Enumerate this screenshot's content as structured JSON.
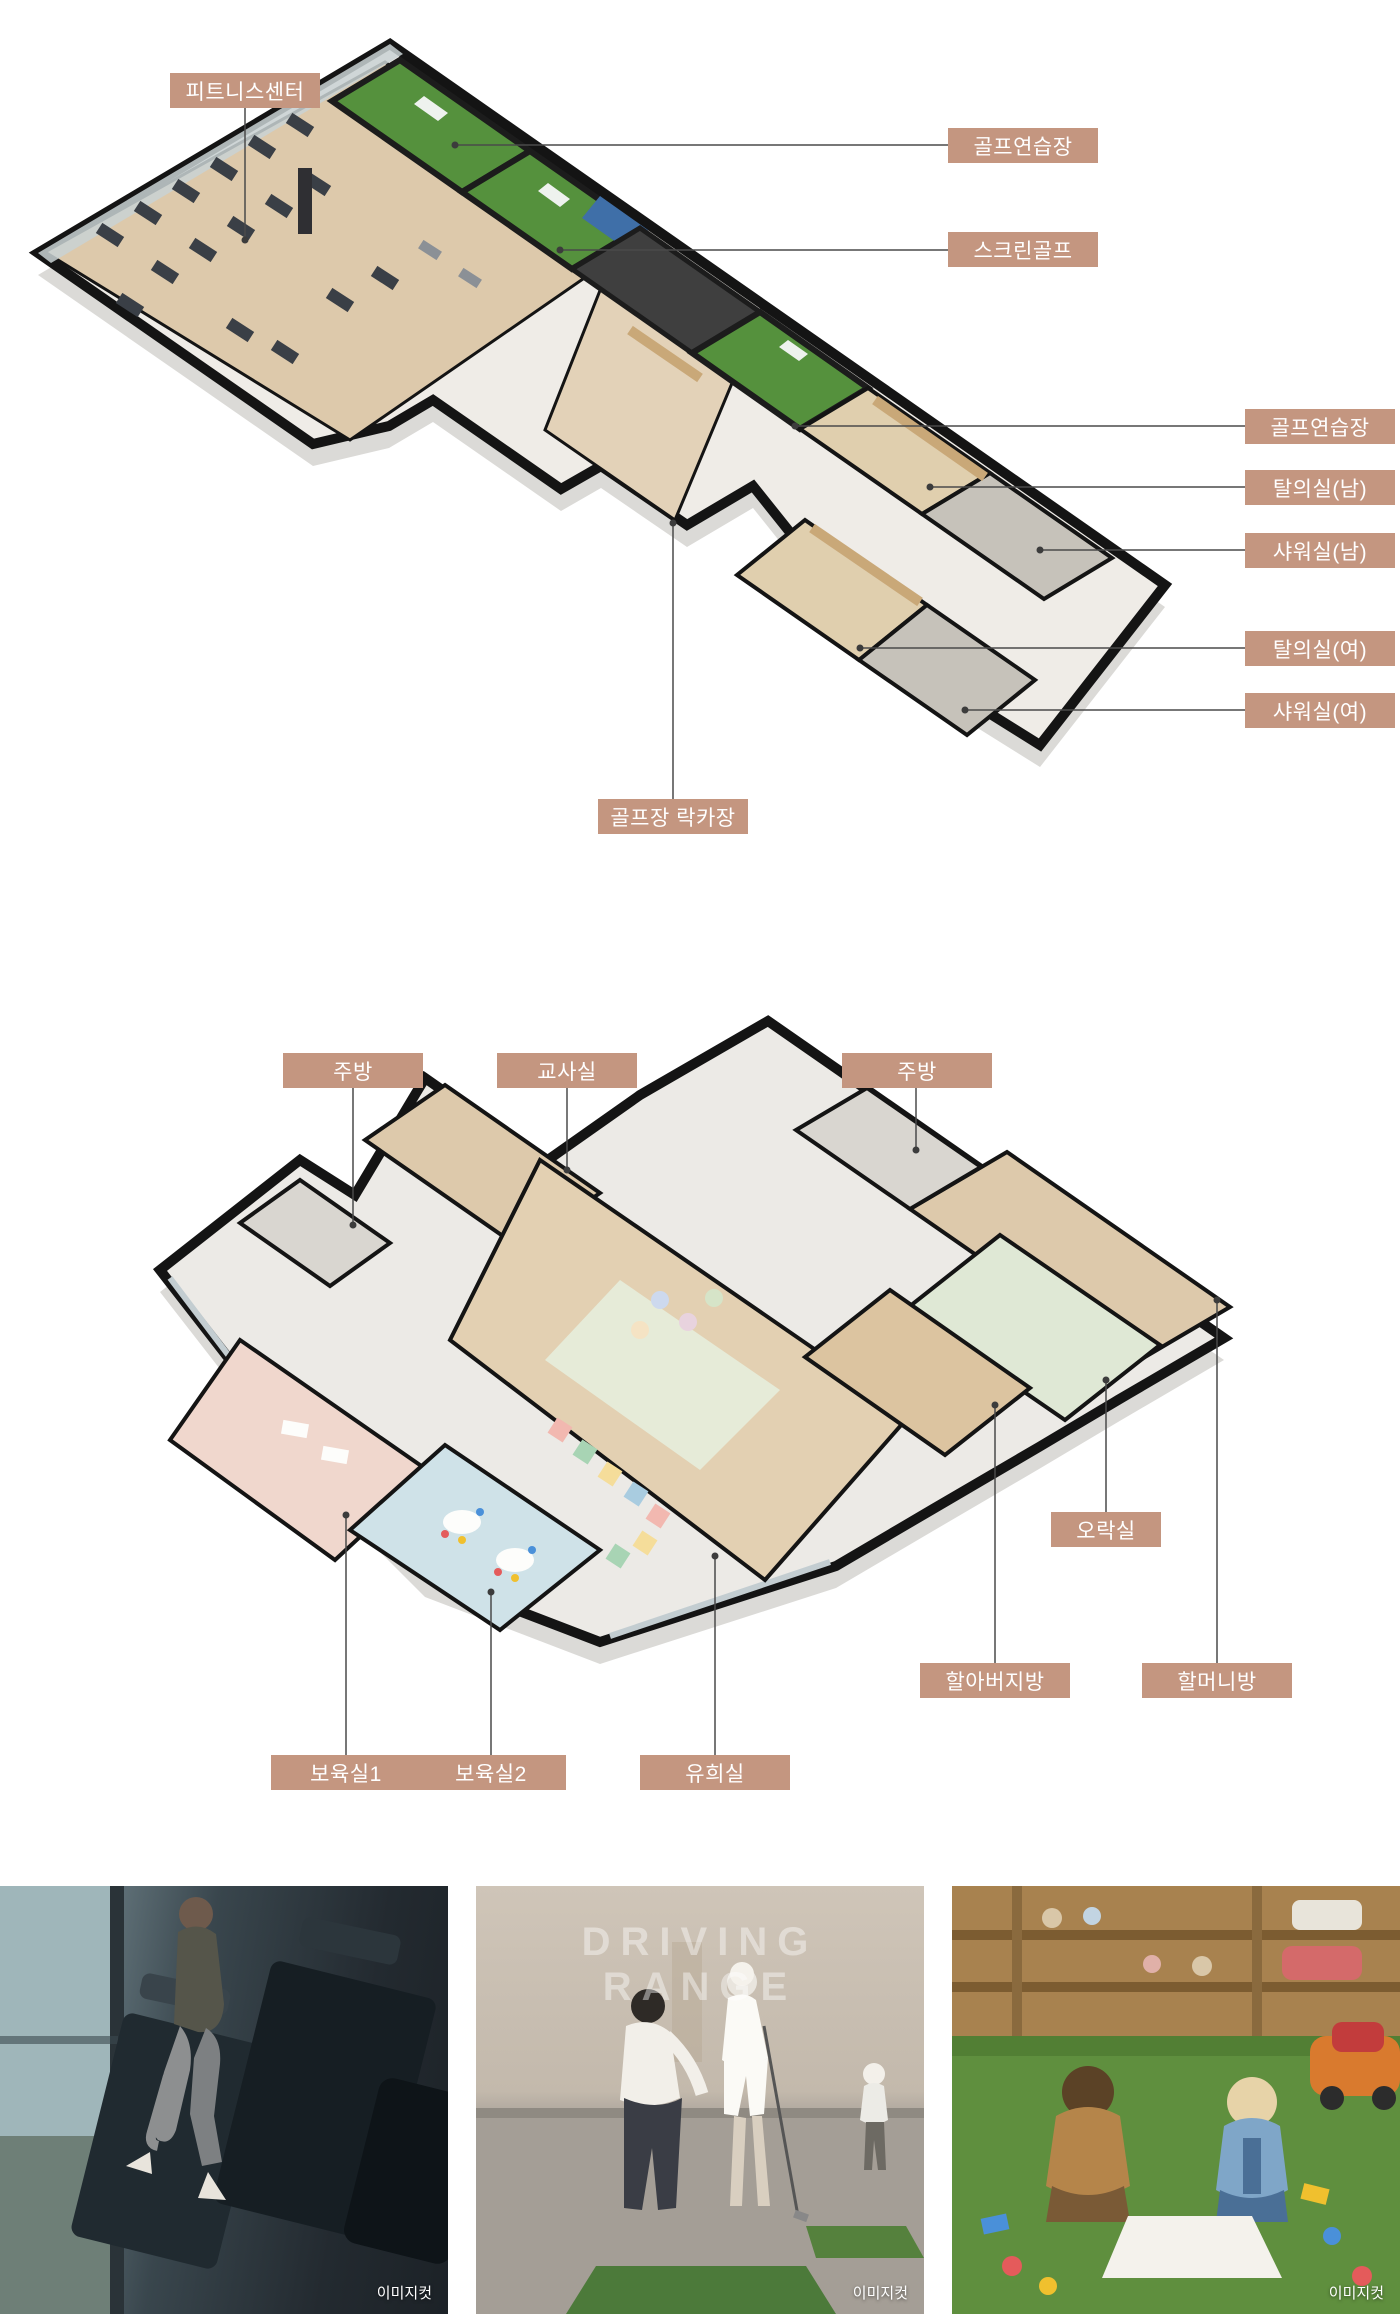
{
  "colors": {
    "label_bg": "#c49680",
    "label_text": "#ffffff",
    "leader_line": "#4a4a4a",
    "wall": "#141414",
    "wood_floor": "#ddc9ab",
    "golf_turf": "#55913d",
    "screen_blue": "#3f6fa8",
    "shower_gray": "#c6c2ba",
    "locker_tan": "#c9a878",
    "nursery1_pink": "#f0d7cd",
    "nursery2_blue": "#cfe2e8",
    "gameroom_green": "#dfe8d5",
    "kitchen_gray": "#d9d6d0",
    "grass_green": "#5f8f3e"
  },
  "plan1": {
    "labels": [
      {
        "id": "fitness-center",
        "text": "피트니스센터"
      },
      {
        "id": "golf-range-1",
        "text": "골프연습장"
      },
      {
        "id": "screen-golf",
        "text": "스크린골프"
      },
      {
        "id": "golf-range-2",
        "text": "골프연습장"
      },
      {
        "id": "locker-men",
        "text": "탈의실(남)"
      },
      {
        "id": "shower-men",
        "text": "샤워실(남)"
      },
      {
        "id": "locker-women",
        "text": "탈의실(여)"
      },
      {
        "id": "shower-women",
        "text": "샤워실(여)"
      },
      {
        "id": "golf-locker",
        "text": "골프장 락카장"
      }
    ]
  },
  "plan2": {
    "labels": [
      {
        "id": "kitchen-1",
        "text": "주방"
      },
      {
        "id": "teachers-room",
        "text": "교사실"
      },
      {
        "id": "kitchen-2",
        "text": "주방"
      },
      {
        "id": "game-room",
        "text": "오락실"
      },
      {
        "id": "grandfather-room",
        "text": "할아버지방"
      },
      {
        "id": "grandmother-room",
        "text": "할머니방"
      },
      {
        "id": "nursery-1",
        "text": "보육실1"
      },
      {
        "id": "nursery-2",
        "text": "보육실2"
      },
      {
        "id": "play-room",
        "text": "유희실"
      }
    ]
  },
  "photos": [
    {
      "watermark": "이미지컷"
    },
    {
      "watermark": "이미지컷",
      "wall_text": "DRIVING RANGE"
    },
    {
      "watermark": "이미지컷"
    }
  ]
}
